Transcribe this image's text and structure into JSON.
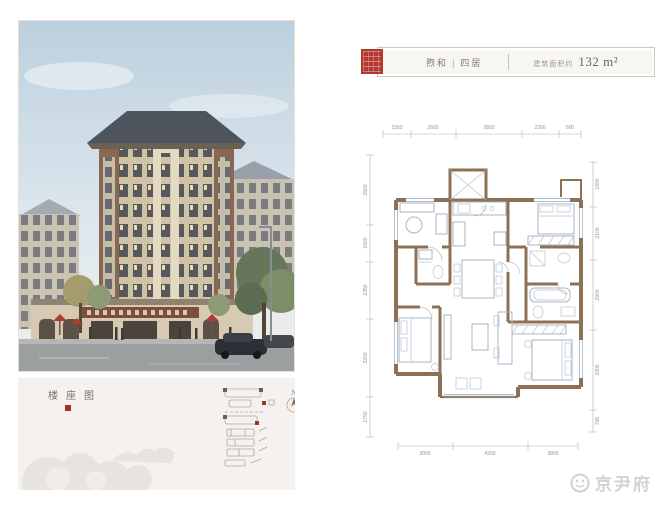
{
  "header": {
    "unit_name": "煦和",
    "separator": "|",
    "unit_type": "四居",
    "area_label": "建筑面积约",
    "area_value": "132 m²"
  },
  "floorplan": {
    "dims_top": [
      "1550",
      "2600",
      "3800",
      "2200",
      "600"
    ],
    "dims_left": [
      "2900",
      "1500",
      "2350",
      "3200",
      "1750"
    ],
    "dims_right": [
      "1800",
      "2100",
      "2900",
      "3300",
      "700"
    ],
    "dims_bottom": [
      "3000",
      "4200",
      "3800"
    ]
  },
  "site_panel": {
    "title": "楼座图",
    "compass": "N"
  },
  "watermark": {
    "text": "京尹府"
  },
  "colors": {
    "wall": "#8c7157",
    "furniture": "#a9b6c3",
    "seal_red": "#b23830",
    "marker_red": "#a33228",
    "panel_bg": "#f4f1ee",
    "dim_text": "#9a938c"
  }
}
